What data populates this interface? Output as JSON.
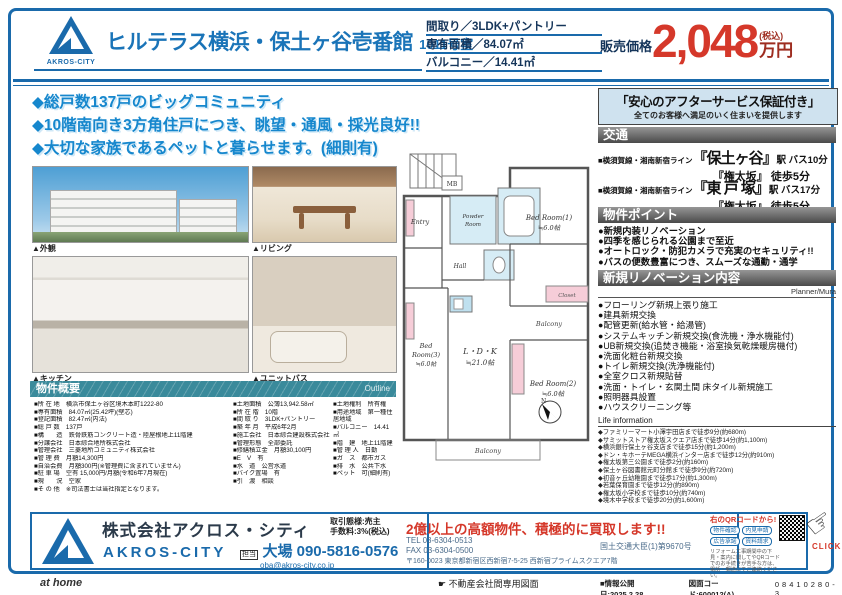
{
  "header": {
    "brand": "AKROS-CITY",
    "title": "ヒルテラス横浜・保土ヶ谷壱番館",
    "room": "1011号室",
    "specs": {
      "madori": "間取り／3LDK+パントリー",
      "menseki": "専有面積／84.07㎡",
      "balcony": "バルコニー／14.41㎡"
    },
    "price": {
      "label": "販売価格",
      "amount": "2,048",
      "tax": "(税込)",
      "unit": "万円"
    }
  },
  "highlights": {
    "line1": "◆総戸数137戸のビッグコミュニティ",
    "line2": "◆10階南向き3方角住戸につき、眺望・通風・採光良好!!",
    "line3": "◆大切な家族であるペットと暮らせます。(細則有)"
  },
  "photos": {
    "cap1": "▲外観",
    "cap2": "▲リビング",
    "cap3": "▲キッチン",
    "cap4": "▲ユニットバス"
  },
  "outline": {
    "title": "物件概要",
    "en": "Outline",
    "col1": [
      "■所 在 地　横浜市保土ヶ谷区境木本町1222-80",
      "■専有面積　84.07㎡(25.42坪)(壁芯)",
      "■登記面積　82.47㎡(内法)",
      "■総 戸 数　137戸",
      "■構　　造　鉄骨鉄筋コンクリート造・陸屋根地上11階建",
      "■分譲会社　日本綜合地所株式会社",
      "■管理会社　三菱地所コミュニティ株式会社",
      "■管 理 費　月額14,300円",
      "■自治会費　月額300円(※管理費に含まれていません)",
      "■駐 車 場　空有 15,000円/月額(令和6年7月現在)",
      "■現　　況　空家",
      "■そ の 他　※司法書士は当社指定となります。"
    ],
    "col2": [
      "■土地面積　公簿13,942.58㎡",
      "■所 在 階　10階",
      "■間 取 り　3LDK+パントリー",
      "■築 年 月　平成6年2月",
      "■施工会社　日本綜合建設株式会社",
      "■管理形態　全部委託",
      "■修繕積立金　月額30,100円",
      "■E　V　有",
      "■水　道　公営水道",
      "■バイク置場　有",
      "■引　渡　相談"
    ],
    "col3": [
      "■土地権利　所有権",
      "■用途地域　第一種住居地域",
      "■バルコニー　14.41㎡",
      "■階　建　地上11階建",
      "■管 理 人　日勤",
      "■ガ　ス　都市ガス",
      "■排　水　公共下水",
      "■ペット　可(細則有)"
    ]
  },
  "floorplan": {
    "ldk": "L・D・K",
    "ldk_size": "≒21.0帖",
    "bed1": "Bed Room(1)",
    "bed1_size": "≒6.0帖",
    "bed2": "Bed Room(2)",
    "bed2_size": "≒6.0帖",
    "bed3": "Bed",
    "bed3b": "Room(3)",
    "bed3_size": "≒6.0帖",
    "entry": "Entry",
    "powder1": "Powder",
    "powder2": "Room",
    "hall": "Hall",
    "closet": "Closet",
    "mb": "MB",
    "balcony1": "Balcony",
    "balcony2": "Balcony",
    "north": "N"
  },
  "aftercare": {
    "title": "「安心のアフターサービス保証付き」",
    "subtitle": "全てのお客様へ満足のいく住まいを提供します"
  },
  "access": {
    "title": "交通",
    "items": [
      {
        "rail": "■横須賀線・湘南新宿ライン",
        "station": "『保土ヶ谷』",
        "mode": "駅 バス10分",
        "sub": "『権太坂』 徒歩5分"
      },
      {
        "rail": "■横須賀線・湘南新宿ライン",
        "station": "『東 戸 塚』",
        "mode": "駅 バス17分",
        "sub": "『権太坂』 徒歩5分"
      }
    ]
  },
  "points": {
    "title": "物件ポイント",
    "items": [
      "●新規内装リノベーション",
      "●四季を感じられる公園まで至近",
      "●オートロック・防犯カメラで充実のセキュリティ!!",
      "●バスの便数豊富につき、スムーズな通勤・通学"
    ]
  },
  "renovation": {
    "title": "新規リノベーション内容",
    "planner": "Planner/Mura",
    "items": [
      "●フローリング新規上張り施工",
      "●建具新規交換",
      "●配管更新(給水管・給湯管)",
      "●システムキッチン新規交換(食洗機・浄水機能付)",
      "●UB新規交換(追焚き機能・浴室換気乾燥暖房機付)",
      "●洗面化粧台新規交換",
      "●トイレ新規交換(洗浄機能付)",
      "●全室クロス新規貼替",
      "●洗面・トイレ・玄関土間 床タイル新規施工",
      "●照明器具設置",
      "●ハウスクリーニング等"
    ]
  },
  "life": {
    "title": "Life information",
    "items": [
      "◆ファミリーマート小澤宇田店まで徒歩9分(約680m)",
      "◆サミットストア権太坂スクエア店まで徒歩14分(約1,100m)",
      "◆横浜銀行保土ヶ谷支店まで徒歩15分(約1,200m)",
      "◆ドン・キホーテMEGA横浜インター店まで徒歩12分(約910m)",
      "◆権太坂第三公園まで徒歩2分(約160m)",
      "◆保土ヶ谷図書館元町分館まで徒歩9分(約720m)",
      "◆初音ヶ丘幼稚園まで徒歩17分(約1,300m)",
      "◆若葉保育園まで徒歩12分(約890m)",
      "◆権太坂小学校まで徒歩10分(約740m)",
      "◆境木中学校まで徒歩20分(約1,600m)"
    ]
  },
  "footer": {
    "company": "株式会社アクロス・シティ",
    "company_en": "AKROS-CITY",
    "deal_type": "取引態様:売主",
    "fee": "手数料:3%(税込)",
    "contact_label": "担当",
    "contact": "大場 090-5816-0576",
    "email": "oba@akros-city.co.jp",
    "buyback": "2億以上の高額物件、積極的に買取します!!",
    "tel": "TEL 03-6304-0513",
    "fax": "FAX 03-6304-0500",
    "address": "〒160-0023 東京都新宿区西新宿7-5-25 西新宿プライムスクエア7階",
    "license": "国土交通大臣(1)第9670号",
    "qr_lead": "右のQRコードから!",
    "qr_buttons": [
      "物件確認",
      "内見申請",
      "広告承諾",
      "資料請求"
    ],
    "qr_note": "リフォーム工事期間中の下見・案内に関してやQRコードでのお手続きが苦手な方は、電話・郵送にてご連絡ください。",
    "click": "CLICK"
  },
  "bottombar": {
    "athome": "at home",
    "center": "不動産会社間専用図面",
    "date": "■情報公開日:2025.2.28",
    "code": "図面コード:600012(A)",
    "number": "08410280-3"
  }
}
